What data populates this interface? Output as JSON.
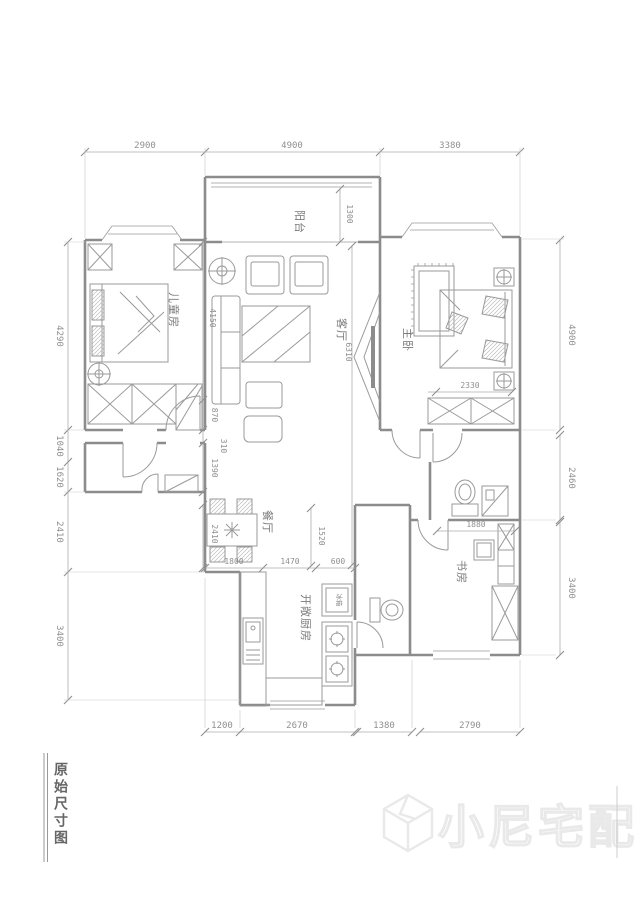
{
  "title_block": {
    "label": "原始尺寸图"
  },
  "watermark": {
    "brand": "小尼宅配"
  },
  "rooms": {
    "balcony": "阳台",
    "children_room": "儿童房",
    "living_room": "客厅",
    "master_bedroom": "主卧",
    "dining_room": "餐厅",
    "open_kitchen": "开敞厨房",
    "study": "书房",
    "fridge": "冰箱"
  },
  "dimensions": {
    "top": [
      "2900",
      "4900",
      "3380"
    ],
    "left": [
      "4290",
      "1040",
      "1620",
      "2410",
      "3400"
    ],
    "right": [
      "4900",
      "2460",
      "3400"
    ],
    "bottom": [
      "1200",
      "2670",
      "1380",
      "2790"
    ],
    "inner": {
      "balcony_depth": "1300",
      "living_length": "6310",
      "sofa_wall": "4150",
      "hall_a": "870",
      "hall_b": "310",
      "hall_c": "1390",
      "dining_width": "1800",
      "dining_depth": "2410",
      "pass_width": "1470",
      "fridge_width": "600",
      "kitchen_opening": "1520",
      "master_wardrobe": "2330",
      "study_top": "1880"
    }
  }
}
